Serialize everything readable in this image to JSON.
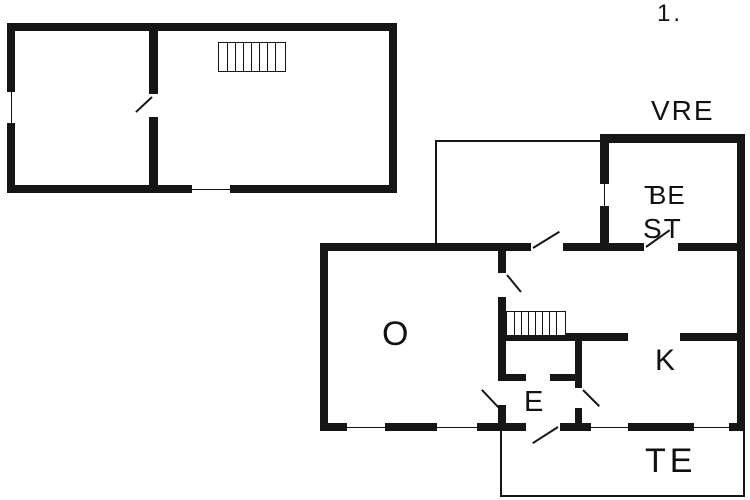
{
  "canvas": {
    "width": 750,
    "height": 500,
    "background": "#ffffff",
    "wall_color": "#161616",
    "text_color": "#111111"
  },
  "title": {
    "floor_number": "1."
  },
  "labels": [
    {
      "id": "floor-number",
      "text": "1.",
      "x": 657,
      "y": 2,
      "size": 24,
      "ls": 3
    },
    {
      "id": "room-label-vre",
      "text": "VRE",
      "x": 651,
      "y": 97,
      "size": 28,
      "ls": 2
    },
    {
      "id": "room-label-be",
      "text": "BE",
      "x": 649,
      "y": 182,
      "size": 26,
      "ls": 1
    },
    {
      "id": "room-label-be-overlap",
      "text": "T",
      "x": 644,
      "y": 182,
      "size": 26,
      "ls": 0
    },
    {
      "id": "room-label-st",
      "text": "ST",
      "x": 643,
      "y": 215,
      "size": 28,
      "ls": 2
    },
    {
      "id": "room-label-o",
      "text": "O",
      "x": 382,
      "y": 317,
      "size": 34,
      "ls": 0
    },
    {
      "id": "room-label-k",
      "text": "K",
      "x": 655,
      "y": 346,
      "size": 30,
      "ls": 0
    },
    {
      "id": "room-label-e",
      "text": "E",
      "x": 524,
      "y": 388,
      "size": 29,
      "ls": 0
    },
    {
      "id": "room-label-te",
      "text": "TE",
      "x": 645,
      "y": 444,
      "size": 34,
      "ls": 4
    }
  ],
  "walls": [
    {
      "id": "upper-top",
      "x": 7,
      "y": 23,
      "w": 390,
      "h": 8
    },
    {
      "id": "upper-bottom",
      "x": 7,
      "y": 185,
      "w": 390,
      "h": 8
    },
    {
      "id": "upper-left",
      "x": 7,
      "y": 23,
      "w": 8,
      "h": 170
    },
    {
      "id": "upper-right",
      "x": 389,
      "y": 23,
      "w": 8,
      "h": 170
    },
    {
      "id": "upper-divider",
      "x": 149,
      "y": 23,
      "w": 9,
      "h": 170
    },
    {
      "id": "be-top",
      "x": 600,
      "y": 134,
      "w": 145,
      "h": 9
    },
    {
      "id": "main-right",
      "x": 737,
      "y": 134,
      "w": 8,
      "h": 297
    },
    {
      "id": "be-left",
      "x": 600,
      "y": 134,
      "w": 9,
      "h": 113
    },
    {
      "id": "be-bottom",
      "x": 600,
      "y": 243,
      "w": 145,
      "h": 8
    },
    {
      "id": "main-top",
      "x": 320,
      "y": 243,
      "w": 288,
      "h": 8
    },
    {
      "id": "main-left",
      "x": 320,
      "y": 243,
      "w": 8,
      "h": 188
    },
    {
      "id": "main-bottom",
      "x": 320,
      "y": 423,
      "w": 425,
      "h": 8
    },
    {
      "id": "hall-wall-a1",
      "x": 498,
      "y": 251,
      "w": 8,
      "h": 22
    },
    {
      "id": "hall-wall-a2",
      "x": 498,
      "y": 297,
      "w": 8,
      "h": 84
    },
    {
      "id": "hall-wall-a3",
      "x": 498,
      "y": 405,
      "w": 8,
      "h": 26
    },
    {
      "id": "kitchen-top-b1",
      "x": 506,
      "y": 333,
      "w": 122,
      "h": 8
    },
    {
      "id": "kitchen-top-b2",
      "x": 680,
      "y": 333,
      "w": 57,
      "h": 8
    },
    {
      "id": "entry-right-c1",
      "x": 575,
      "y": 341,
      "w": 7,
      "h": 47
    },
    {
      "id": "entry-right-c2",
      "x": 575,
      "y": 408,
      "w": 7,
      "h": 23
    },
    {
      "id": "entry-top-d1",
      "x": 506,
      "y": 374,
      "w": 20,
      "h": 7
    },
    {
      "id": "entry-top-d2",
      "x": 550,
      "y": 374,
      "w": 25,
      "h": 7
    }
  ],
  "thin_walls": [
    {
      "id": "annex-top",
      "x": 435,
      "y": 140,
      "w": 165,
      "h": 2
    },
    {
      "id": "annex-left",
      "x": 435,
      "y": 140,
      "w": 2,
      "h": 103
    },
    {
      "id": "terrace-left",
      "x": 500,
      "y": 431,
      "w": 2,
      "h": 66
    },
    {
      "id": "terrace-bottom",
      "x": 500,
      "y": 495,
      "w": 245,
      "h": 2
    },
    {
      "id": "terrace-right",
      "x": 743,
      "y": 431,
      "w": 2,
      "h": 66
    }
  ],
  "openings": [
    {
      "id": "upper-divider-doorway",
      "x": 148,
      "y": 94,
      "w": 11,
      "h": 23
    },
    {
      "id": "be-doorway",
      "x": 644,
      "y": 242,
      "w": 34,
      "h": 10
    },
    {
      "id": "annex-doorway",
      "x": 531,
      "y": 242,
      "w": 32,
      "h": 10
    },
    {
      "id": "terrace-doorway",
      "x": 526,
      "y": 422,
      "w": 34,
      "h": 10
    }
  ],
  "windows": [
    {
      "id": "upper-left-window",
      "x": 6,
      "y": 92,
      "w": 10,
      "h": 31,
      "orient": "v"
    },
    {
      "id": "upper-bottom-window",
      "x": 192,
      "y": 184,
      "w": 38,
      "h": 10,
      "orient": "h"
    },
    {
      "id": "be-left-window",
      "x": 599,
      "y": 184,
      "w": 11,
      "h": 22,
      "orient": "v"
    },
    {
      "id": "living-window-1",
      "x": 347,
      "y": 422,
      "w": 38,
      "h": 10,
      "orient": "h"
    },
    {
      "id": "living-window-2",
      "x": 437,
      "y": 422,
      "w": 40,
      "h": 10,
      "orient": "h"
    },
    {
      "id": "kitchen-window-1",
      "x": 591,
      "y": 422,
      "w": 37,
      "h": 10,
      "orient": "h"
    },
    {
      "id": "kitchen-window-2",
      "x": 694,
      "y": 422,
      "w": 35,
      "h": 10,
      "orient": "h"
    }
  ],
  "doors": [
    {
      "id": "upper-divider-door",
      "x1": 152,
      "y1": 96,
      "x2": 136,
      "y2": 111
    },
    {
      "id": "annex-door",
      "x1": 533,
      "y1": 247,
      "x2": 559,
      "y2": 231
    },
    {
      "id": "be-door",
      "x1": 646,
      "y1": 246,
      "x2": 670,
      "y2": 229
    },
    {
      "id": "hall-door",
      "x1": 507,
      "y1": 274,
      "x2": 521,
      "y2": 291
    },
    {
      "id": "living-entry-door",
      "x1": 499,
      "y1": 407,
      "x2": 482,
      "y2": 389
    },
    {
      "id": "entry-kitchen-door",
      "x1": 583,
      "y1": 389,
      "x2": 599,
      "y2": 405
    },
    {
      "id": "entry-terrace-door",
      "x1": 558,
      "y1": 426,
      "x2": 533,
      "y2": 442
    }
  ],
  "stairs": [
    {
      "id": "stairs-upper-floor",
      "x": 218,
      "y": 42,
      "w": 66,
      "h": 28,
      "pitch": 8
    },
    {
      "id": "stairs-ground-floor",
      "x": 506,
      "y": 311,
      "w": 58,
      "h": 23,
      "pitch": 7
    }
  ]
}
